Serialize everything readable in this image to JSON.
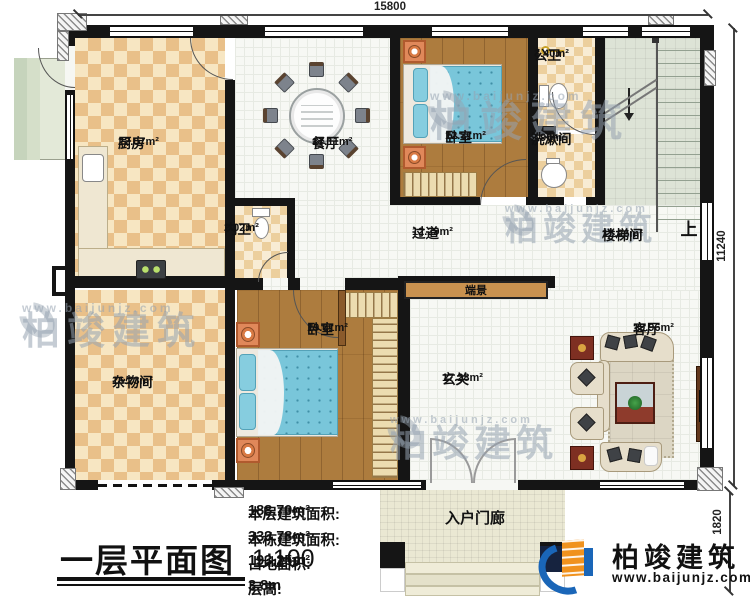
{
  "plan": {
    "dimensions": {
      "top": "15800",
      "right": "11240",
      "porch": "1820"
    },
    "rooms": [
      {
        "key": "kitchen",
        "name": "厨房",
        "area": "22.07m²"
      },
      {
        "key": "dining",
        "name": "餐厅",
        "area": "17.11m²"
      },
      {
        "key": "bedroom_top",
        "name": "卧室",
        "area": "12.31m²"
      },
      {
        "key": "public_bath",
        "name": "公卫",
        "area": "3.40m²"
      },
      {
        "key": "washroom",
        "name": "洗漱间",
        "area": "2.90m²"
      },
      {
        "key": "stairwell",
        "name": "楼梯间",
        "area": "15.26m²"
      },
      {
        "key": "hallway",
        "name": "过道",
        "area": "12.29m²"
      },
      {
        "key": "inner_bath",
        "name": "内卫",
        "area": "2.02m²"
      },
      {
        "key": "storage",
        "name": "杂物间",
        "area": "16.23m²"
      },
      {
        "key": "bedroom_bottom",
        "name": "卧室",
        "area": "19.01m²"
      },
      {
        "key": "foyer",
        "name": "玄关",
        "area": "17.28m²"
      },
      {
        "key": "living",
        "name": "客厅",
        "area": "19.96m²"
      }
    ],
    "porch_label": "入户门廊",
    "console_label": "端景",
    "stair_up": "上"
  },
  "title_block": {
    "title": "一层平面图",
    "scale": "1:100"
  },
  "stats": [
    {
      "label": "本层建筑面积:",
      "value": "188.70m²"
    },
    {
      "label": "本栋建筑面积:",
      "value": "333.78m²"
    },
    {
      "label": "占地面积:",
      "value": "193.25m²"
    },
    {
      "label": "层高:",
      "value": "3.8m"
    }
  ],
  "brand": {
    "name": "柏竣建筑",
    "url": "www.baijunjz.com"
  },
  "watermark": {
    "name": "柏竣建筑",
    "url": "www.baijunjz.com"
  },
  "colors": {
    "wall": "#151515",
    "checker_dark": "#e9c089",
    "checker_light": "#f7e6c2",
    "wood": "#ad7c3e",
    "bed": "#7cc5da",
    "stair_floor": "#dde3d6",
    "brand_blue": "#1a66b8",
    "brand_orange": "#f0921e"
  }
}
